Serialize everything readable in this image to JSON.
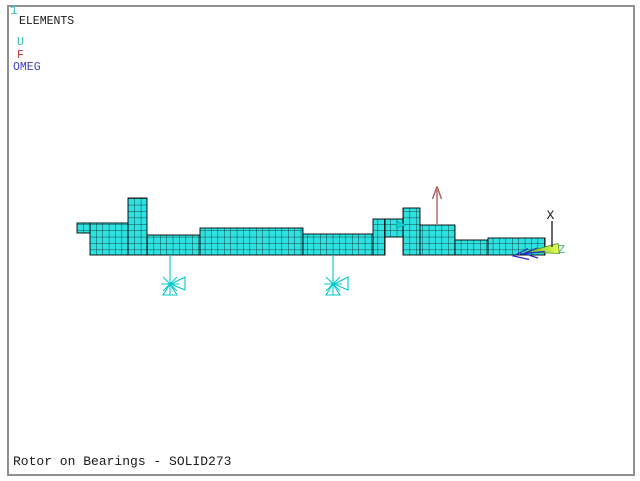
{
  "window": {
    "id_label": "1",
    "view_label": "ELEMENTS",
    "title": "Rotor on Bearings - SOLID273"
  },
  "legend": {
    "items": [
      {
        "label": "U",
        "color": "#3fbcbc"
      },
      {
        "label": "F",
        "color": "#c23a3a"
      },
      {
        "label": "OMEG",
        "color": "#3c3cc2"
      }
    ]
  },
  "triad": {
    "x_label": "X",
    "z_label": "Z",
    "x_color": "#1a1a1a",
    "z_color": "#44bb77"
  },
  "colors": {
    "background": "#ffffff",
    "frame_border": "#8f8f8f",
    "mesh_fill": "#2ee2e2",
    "mesh_grid": "#141414",
    "mesh_outline": "#000000",
    "bearing": "#00c9c9",
    "constraint_marker": "#19d0d0",
    "force_arrow": "#b05050",
    "omega_arrow": "#2a2ac0",
    "axis_arrow_green": "#5abb22",
    "axis_arrow_yellow": "#f2fa55"
  }
}
